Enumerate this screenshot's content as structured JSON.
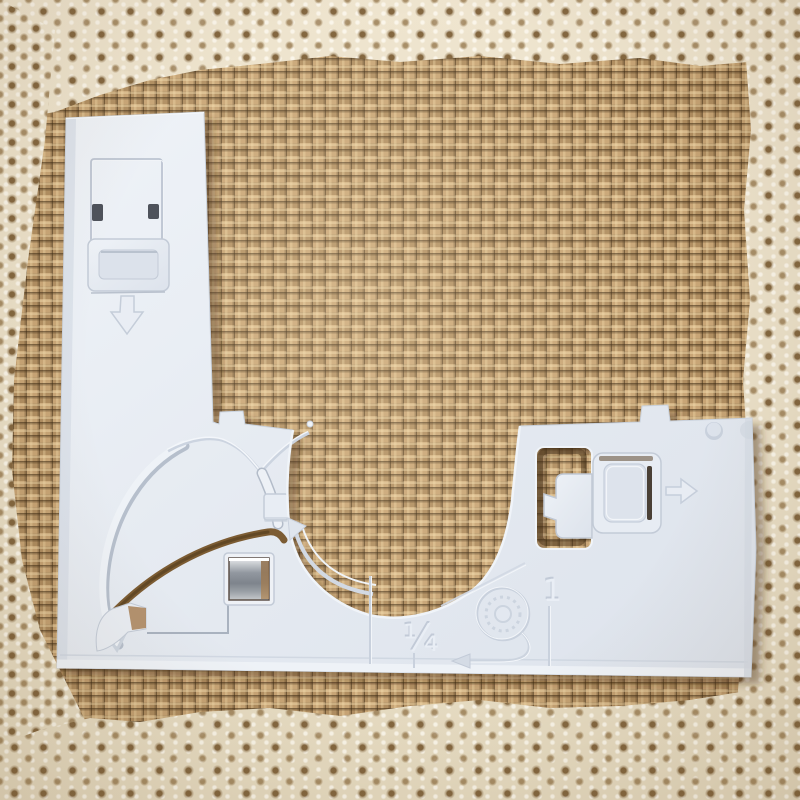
{
  "scene": {
    "description": "Product photo of a white plastic sewing-machine quarter-inch guide attachment plate lying on burlap fabric framed by cream crochet lace trim",
    "background": {
      "fabric": "burlap weave",
      "border": "crochet lace trim",
      "colors": {
        "burlap": "#c49e6c",
        "burlap_gap": "#4a3415",
        "lace": "#eae0c8"
      }
    },
    "attachment": {
      "kind": "sewing machine guide attachment",
      "material_color": "#e5eaf1",
      "shadow_color": "#b9c2cf",
      "metal_color": "#9aa0a6",
      "markings": {
        "quarter_inch": "¼",
        "one": "1"
      },
      "embossed_icons": [
        "down-arrow",
        "right-arrow",
        "curved-arrow",
        "left-arrow",
        "bobbin-thread"
      ]
    }
  }
}
